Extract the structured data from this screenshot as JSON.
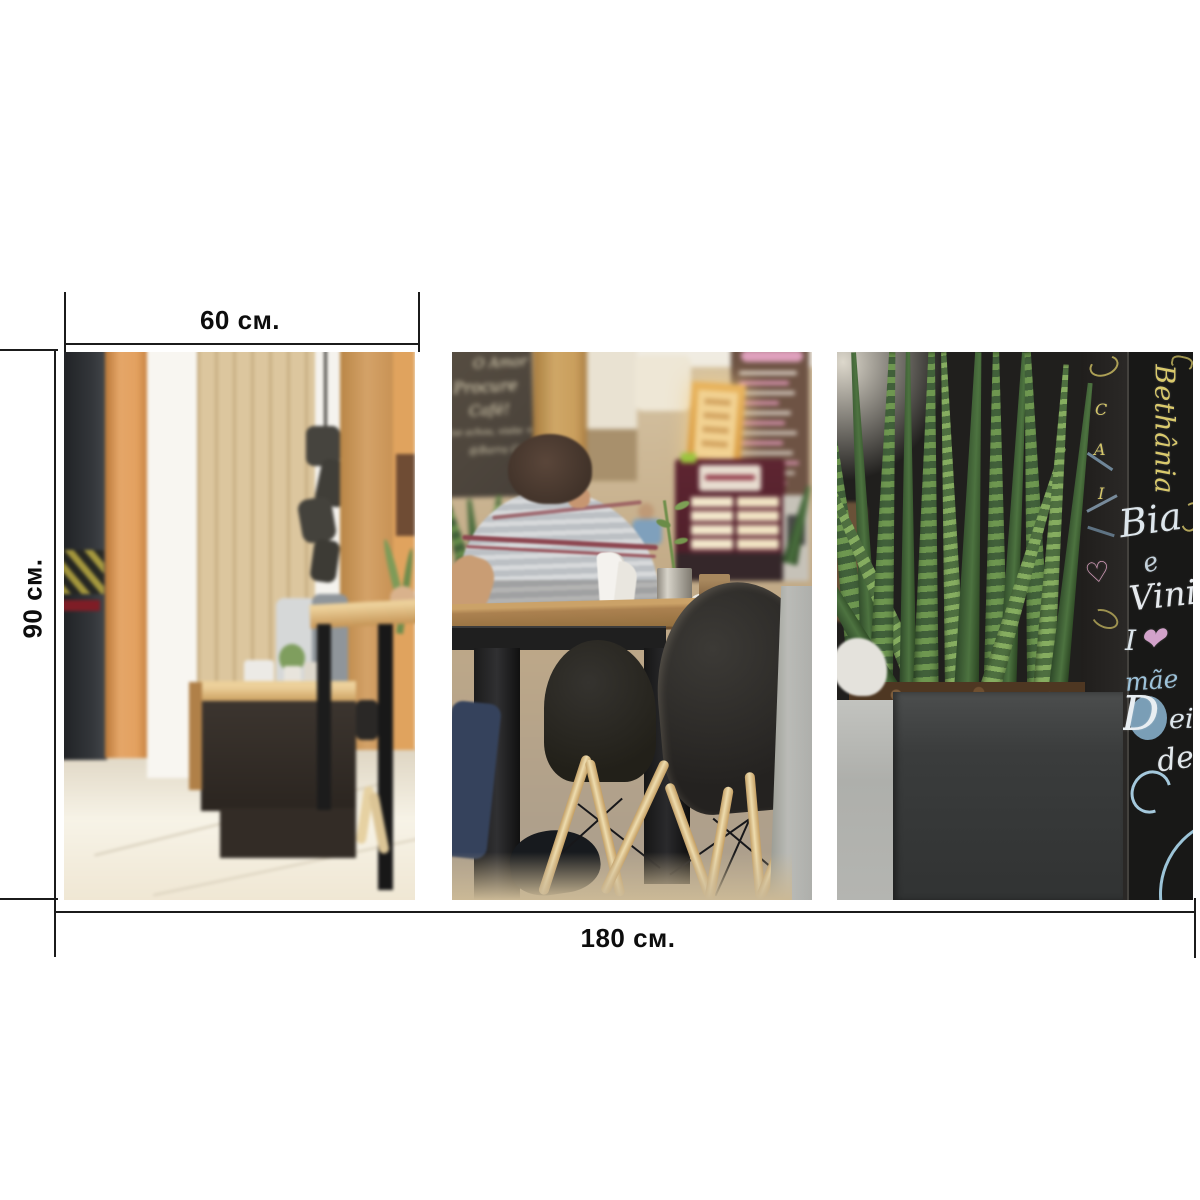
{
  "dimensions": {
    "panel_width_label": "60 см.",
    "height_label": "90 см.",
    "total_width_label": "180 см."
  },
  "left_chalkboard": {
    "line1": "O Amor",
    "line2": "Procure",
    "line3": "Café!",
    "line4": "(se achou, visite + fiel)",
    "line5": "@Barra Café"
  },
  "name_wall": {
    "vertical_name": "Bethânia",
    "name_top": "Bia",
    "connector": "e",
    "name_mid": "Vini",
    "love_prefix": "I",
    "love_heart": "❤",
    "mom_word": "mãe",
    "big_initial": "D",
    "partial_suffix": "ei",
    "word_de": "de",
    "side_letters": [
      "C",
      "A",
      "I"
    ],
    "side_heart": "♡"
  },
  "colors": {
    "dimension_line": "#1b1b1b",
    "chalk_yellow": "#d9c96c",
    "chalk_white": "#e6eaee",
    "chalk_blue": "#9cc2da",
    "chalk_pink": "#d2a2ca",
    "plant_green": "#5f8a47",
    "wood_orange": "#dd9f5f"
  }
}
